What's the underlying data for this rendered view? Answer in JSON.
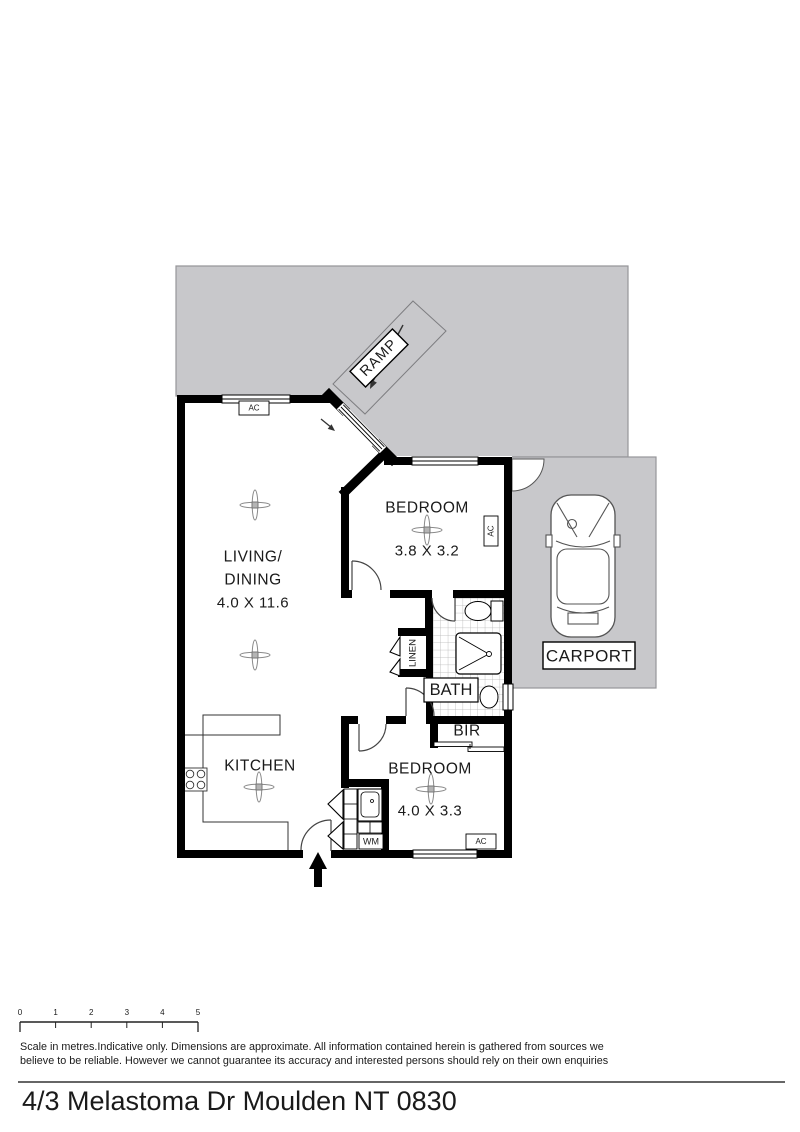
{
  "title": {
    "address": "4/3 Melastoma Dr Moulden NT 0830"
  },
  "disclaimer": {
    "line1": "Scale in metres.Indicative only. Dimensions are approximate. All information contained herein is gathered from sources we",
    "line2": "believe to be reliable. However we cannot guarantee its accuracy and interested persons should rely on their own enquiries"
  },
  "scale_bar": {
    "labels": [
      "0",
      "1",
      "2",
      "3",
      "4",
      "5"
    ]
  },
  "rooms": {
    "living": {
      "name_line1": "LIVING/",
      "name_line2": "DINING",
      "dims": "4.0 X 11.6"
    },
    "bedroom1": {
      "name": "BEDROOM",
      "dims": "3.8 X 3.2"
    },
    "bedroom2": {
      "name": "BEDROOM",
      "dims": "4.0 X 3.3"
    },
    "kitchen": {
      "name": "KITCHEN"
    },
    "bath": {
      "name": "BATH"
    },
    "bir": {
      "name": "BIR"
    },
    "linen": {
      "name": "LINEN"
    },
    "wm": {
      "name": "WM"
    },
    "carport": {
      "name": "CARPORT"
    },
    "ramp": {
      "name": "RAMP"
    }
  },
  "labels": {
    "ac": "AC"
  },
  "colors": {
    "paving_gray": "#c8c8cb",
    "paving_border": "#96969a",
    "wall_black": "#000000",
    "tile_line": "#b5b5b5",
    "fan_gray": "#8a8a8a",
    "car_line": "#555555"
  }
}
